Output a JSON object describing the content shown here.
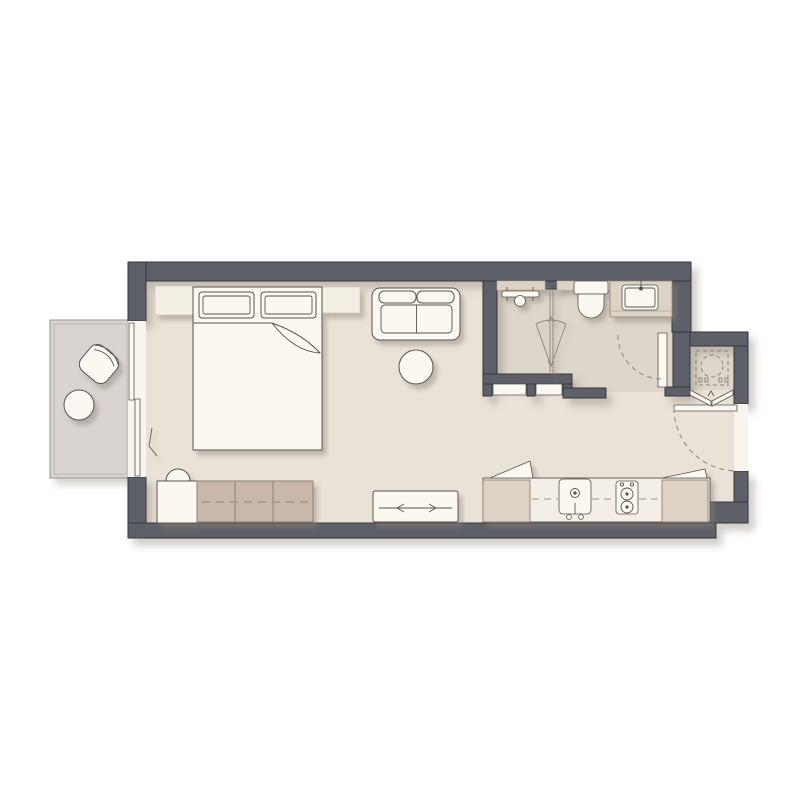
{
  "canvas": {
    "width": 800,
    "height": 800,
    "background": "#ffffff"
  },
  "scene": {
    "type": "architectural floor plan, top-down view, studio apartment",
    "rooms": [
      "main living and sleeping area",
      "shower room",
      "wc and vanity room",
      "entry hall",
      "utility closet",
      "kitchenette",
      "balcony"
    ]
  },
  "colors": {
    "wall": "#5d6067",
    "wall_outline": "#34363b",
    "floor_main": "#eae2d7",
    "floor_bath": "#ded6cb",
    "floor_balcony": "#d9d4d1",
    "counter_white": "#f3efe6",
    "furniture_white": "#fbf8f1",
    "furniture_cream": "#f4efe4",
    "cabinet_beige": "#ddd2c6",
    "wardrobe_taupe": "#c9b7a9",
    "threshold": "#f8f5ee",
    "outline": "#56544d",
    "dashed_line": "#8d8579",
    "shadow": "#8b8173"
  },
  "furniture": {
    "sleeping_area": [
      "double bed with two pillows and folded duvet",
      "nightstand left",
      "nightstand right"
    ],
    "living_area": [
      "two-seat sofa",
      "round ottoman table",
      "tv sideboard with sliding doors",
      "wardrobe with three taupe sections",
      "dresser with stool"
    ],
    "balcony": [
      "lounge chair",
      "round side table"
    ],
    "bathroom": [
      "shower fixture with head",
      "glass partition",
      "spray cone symbol",
      "toilet",
      "vanity counter with washbasin"
    ],
    "kitchen": [
      "countertop",
      "sink with faucet",
      "two-burner hob",
      "base cabinet left",
      "base cabinet right",
      "open cabinet flaps",
      "upper cabinets dashed line"
    ],
    "utility_closet": [
      "washing machine shown dashed",
      "hookup symbols"
    ]
  },
  "doors": [
    "balcony sliding door (two panels)",
    "bathroom swing door with arc",
    "two sliding bathroom panels",
    "entry swing door with arc",
    "bi-fold closet doors"
  ]
}
